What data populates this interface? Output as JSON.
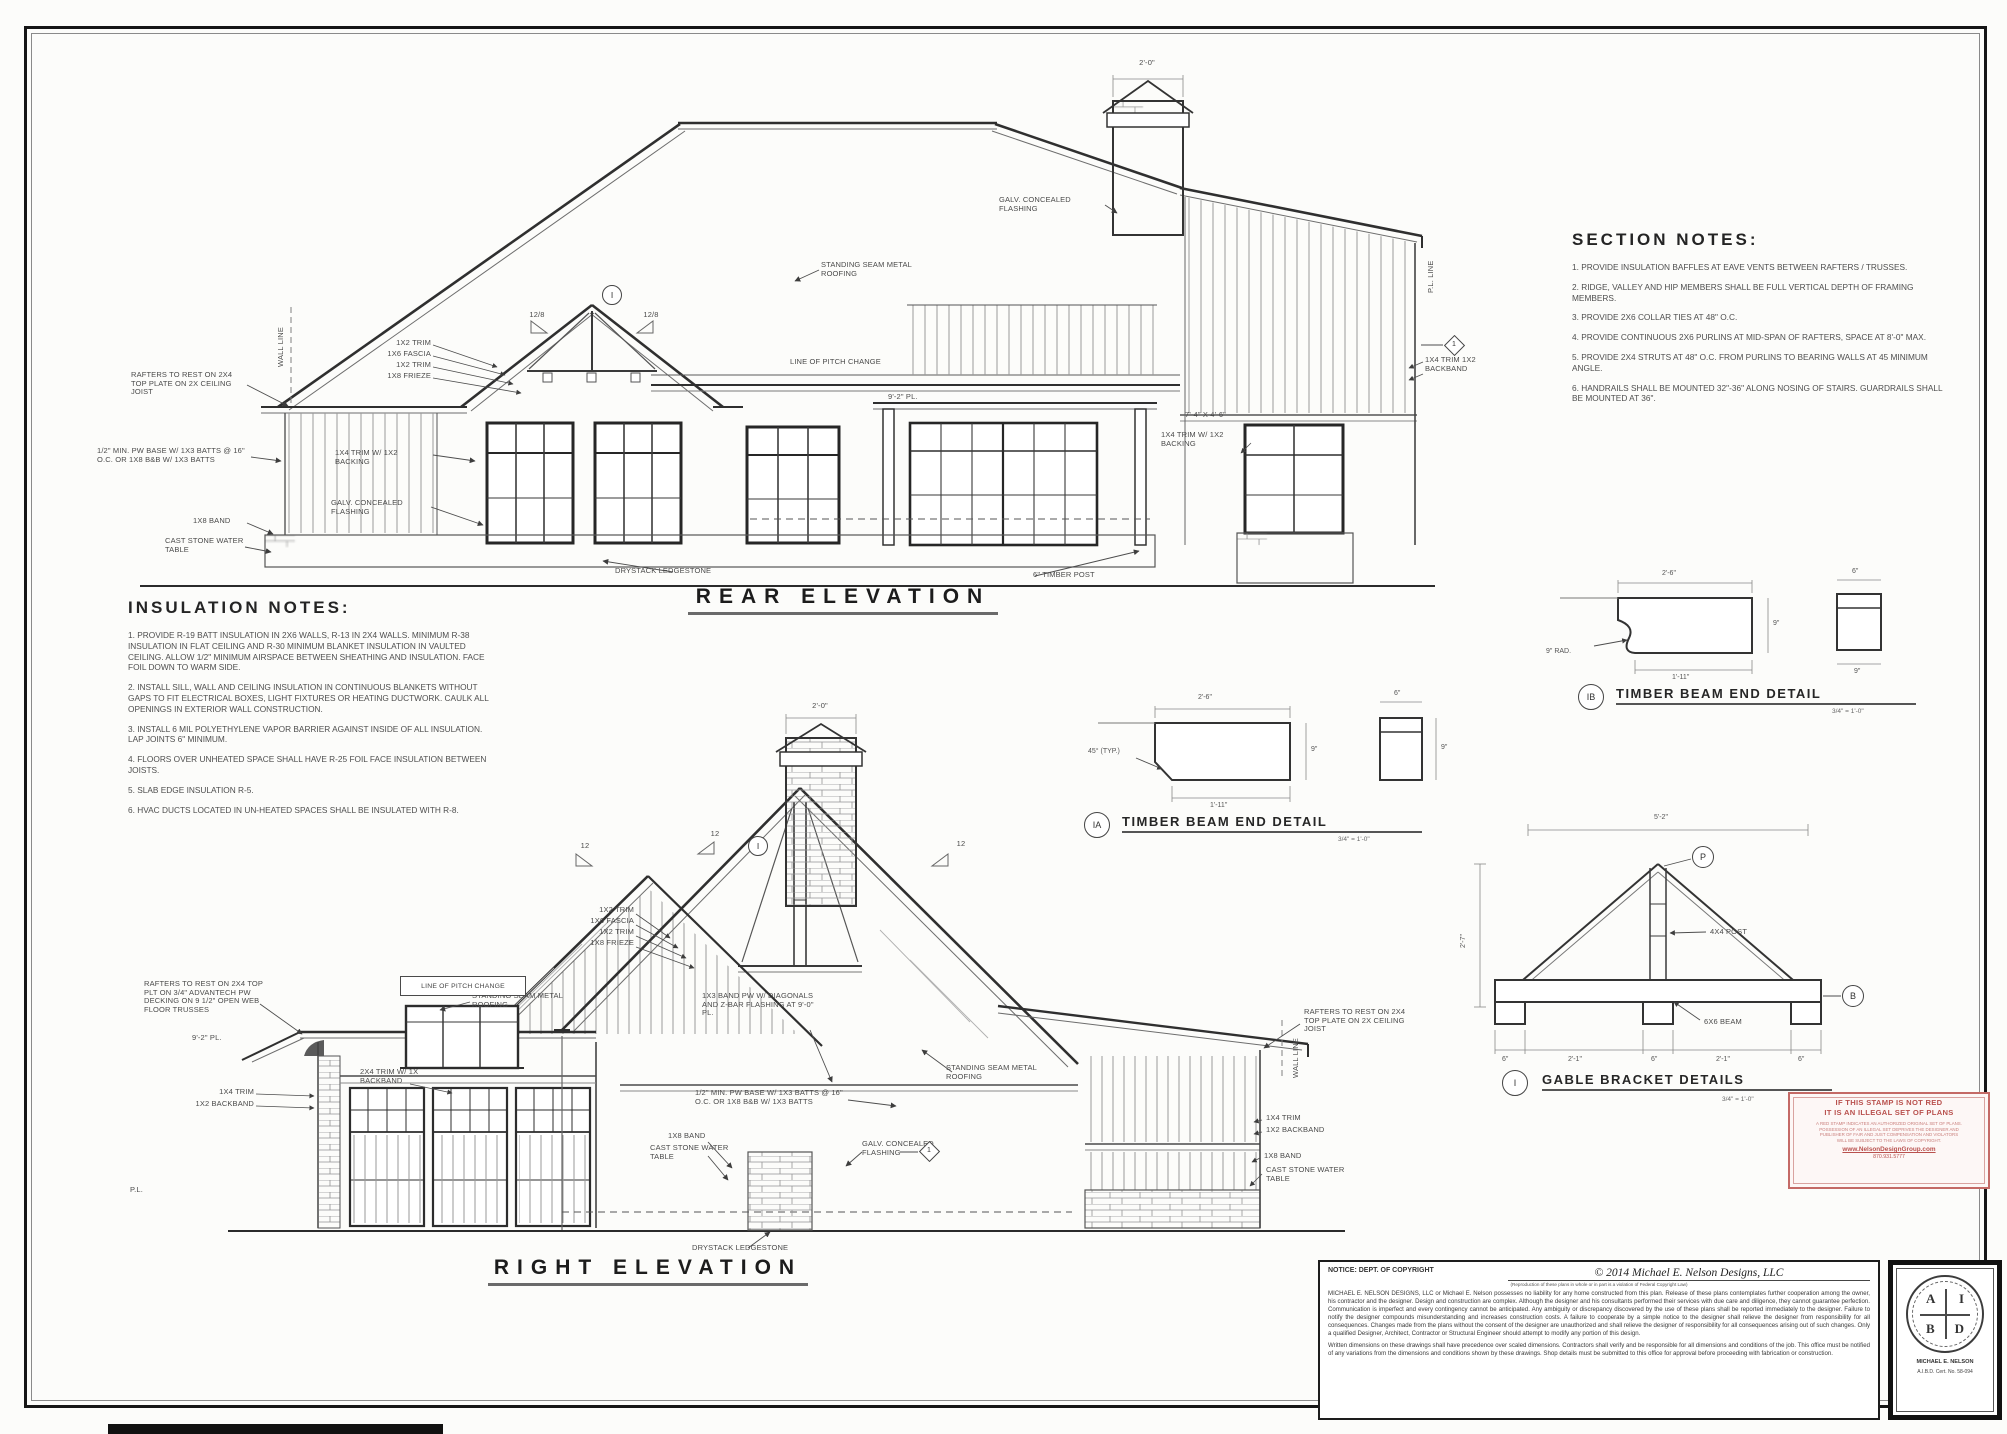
{
  "sheet": {
    "name": "ELEVATION SHEET",
    "paper_color": "#fcfcfa",
    "line_color": "#2f2f2f",
    "stamp_color": "#b9514e"
  },
  "notes": {
    "section": {
      "title": "SECTION NOTES:",
      "items": [
        "1. PROVIDE INSULATION BAFFLES AT EAVE VENTS BETWEEN RAFTERS / TRUSSES.",
        "2. RIDGE, VALLEY AND HIP MEMBERS SHALL BE FULL VERTICAL DEPTH OF FRAMING MEMBERS.",
        "3. PROVIDE 2X6 COLLAR TIES AT 48\" O.C.",
        "4. PROVIDE CONTINUOUS 2X6 PURLINS AT MID-SPAN OF RAFTERS, SPACE AT 8'-0\" MAX.",
        "5. PROVIDE 2X4 STRUTS AT 48\" O.C. FROM PURLINS TO BEARING WALLS AT 45 MINIMUM ANGLE.",
        "6. HANDRAILS SHALL BE MOUNTED 32\"-36\" ALONG NOSING OF STAIRS. GUARDRAILS SHALL BE MOUNTED AT 36\"."
      ]
    },
    "insulation": {
      "title": "INSULATION NOTES:",
      "items": [
        "1. PROVIDE R-19 BATT INSULATION IN 2X6 WALLS, R-13 IN 2X4 WALLS. MINIMUM R-38 INSULATION IN FLAT CEILING AND R-30 MINIMUM BLANKET INSULATION IN VAULTED CEILING. ALLOW 1/2\" MINIMUM AIRSPACE BETWEEN SHEATHING AND INSULATION. FACE FOIL DOWN TO WARM SIDE.",
        "2. INSTALL SILL, WALL AND CEILING INSULATION IN CONTINUOUS BLANKETS WITHOUT GAPS TO FIT ELECTRICAL BOXES, LIGHT FIXTURES OR HEATING DUCTWORK. CAULK ALL OPENINGS IN EXTERIOR WALL CONSTRUCTION.",
        "3. INSTALL 6 MIL POLYETHYLENE VAPOR BARRIER AGAINST INSIDE OF ALL INSULATION. LAP JOINTS 6\" MINIMUM.",
        "4. FLOORS OVER UNHEATED SPACE SHALL HAVE R-25 FOIL FACE INSULATION BETWEEN JOISTS.",
        "5. SLAB EDGE INSULATION R-5.",
        "6. HVAC DUCTS LOCATED IN UN-HEATED SPACES SHALL BE INSULATED WITH R-8."
      ]
    }
  },
  "rear": {
    "title": "REAR ELEVATION",
    "labels": {
      "rafters": "RAFTERS TO REST ON 2X4 TOP PLATE ON 2X CEILING JOIST",
      "pw_base": "1/2\" MIN. PW BASE W/ 1X3 BATTS @ 16\" O.C. OR 1X8 B&B W/ 1X3 BATTS",
      "band": "1X8 BAND",
      "water_table": "CAST STONE WATER TABLE",
      "flashing": "GALV. CONCEALED FLASHING",
      "trim12a": "1X2 TRIM",
      "fascia": "1X6 FASCIA",
      "trim12b": "1X2 TRIM",
      "frieze": "1X8 FRIEZE",
      "trim14_backing": "1X4 TRIM W/ 1X2 BACKING",
      "trim14_backband": "1X4 TRIM 1X2 BACKBAND",
      "seam": "STANDING SEAM METAL ROOFING",
      "pitch_change": "LINE OF PITCH CHANGE",
      "plate": "9'-2\" PL.",
      "window_dim": "7'-4\" X 4'-6\"",
      "ledgestone": "DRYSTACK LEDGESTONE",
      "timber_post": "6\" TIMBER POST",
      "wall_line": "WALL LINE",
      "pl_line": "P.L. LINE",
      "chimney_dim": "2'-0\"",
      "pitch": "12/8",
      "apex_marker": "I",
      "diamond": "1"
    }
  },
  "right": {
    "title": "RIGHT ELEVATION",
    "labels": {
      "rafters_floor": "RAFTERS TO REST ON 2X4 TOP PLT ON 3/4\" ADVANTECH PW DECKING ON 9 1/2\" OPEN WEB FLOOR TRUSSES",
      "rafters_ceiling": "RAFTERS TO REST ON 2X4 TOP PLATE ON 2X CEILING JOIST",
      "plate": "9'-2\" PL.",
      "trim14": "1X4 TRIM",
      "backband": "1X2 BACKBAND",
      "trim24_backband": "2X4 TRIM W/ 1X BACKBAND",
      "seam": "STANDING SEAM METAL ROOFING",
      "trim12a": "1X2 TRIM",
      "fascia": "1X6 FASCIA",
      "trim12b": "1X2 TRIM",
      "frieze": "1X8 FRIEZE",
      "band_flash": "1X3 BAND PW W/ DIAGONALS AND Z-BAR FLASHING AT 9'-0\" PL.",
      "pw_base": "1/2\" MIN. PW BASE W/ 1X3 BATTS @ 16\" O.C. OR 1X8 B&B W/ 1X3 BATTS",
      "band": "1X8 BAND",
      "water_table": "CAST STONE WATER TABLE",
      "flashing": "GALV. CONCEALED FLASHING",
      "pitch_box": "LINE OF PITCH CHANGE",
      "ledgestone": "DRYSTACK LEDGESTONE",
      "wall_line": "WALL LINE",
      "pl": "P.L.",
      "chimney_dim": "2'-0\"",
      "pitch": "12",
      "apex_marker": "I",
      "diamond": "1"
    }
  },
  "details": {
    "timber_a": {
      "marker": "IA",
      "title": "TIMBER BEAM END DETAIL",
      "scale": "3/4\" = 1'-0\"",
      "dim_top": "2'-6\"",
      "dim_bottom": "1'-11\"",
      "dim_side": "9\"",
      "angle": "45° (TYP.)",
      "end_w": "6\"",
      "end_h": "9\""
    },
    "timber_b": {
      "marker": "IB",
      "title": "TIMBER BEAM END DETAIL",
      "scale": "3/4\" = 1'-0\"",
      "dim_top": "2'-6\"",
      "dim_bottom": "1'-11\"",
      "dim_side": "9\"",
      "radius": "9\" RAD.",
      "end_w": "6\"",
      "end_h": "9\""
    },
    "gable": {
      "marker": "I",
      "title": "GABLE BRACKET DETAILS",
      "scale": "3/4\" = 1'-0\"",
      "post": "4X4 POST",
      "beam": "6X6 BEAM",
      "dim_top": "5'-2\"",
      "dim_left": "2'-7\"",
      "dim_b1": "6\"",
      "dim_b2": "2'-1\"",
      "dim_b3": "6\"",
      "dim_b4": "2'-1\"",
      "dim_b5": "6\"",
      "marker_p": "P",
      "marker_b": "B"
    }
  },
  "stamp": {
    "line1": "IF THIS STAMP IS NOT RED",
    "line2": "IT IS AN ILLEGAL SET OF PLANS",
    "small1": "A RED STAMP INDICATES AN AUTHORIZED ORIGINAL SET OF PLANS.",
    "small2": "POSSESSION OF AN ILLEGAL SET DEPRIVES THE DESIGNER AND",
    "small3": "PUBLISHER OF FAIR AND JUST COMPENSATION AND VIOLATORS",
    "small4": "WILL BE SUBJECT TO THE LAWS OF COPYRIGHT.",
    "url": "www.NelsonDesignGroup.com",
    "phone": "870.931.5777"
  },
  "copyright": {
    "notice": "NOTICE: DEPT. OF COPYRIGHT",
    "title": "© 2014 Michael E. Nelson Designs, LLC",
    "subtitle": "(Reproduction of these plans in whole or in part is a violation of Federal Copyright Law)",
    "body1": "MICHAEL E. NELSON DESIGNS, LLC or Michael E. Nelson possesses no liability for any home constructed from this plan. Release of these plans contemplates further cooperation among the owner, his contractor and the designer. Design and construction are complex. Although the designer and his consultants performed their services with due care and diligence, they cannot guarantee perfection. Communication is imperfect and every contingency cannot be anticipated. Any ambiguity or discrepancy discovered by the use of these plans shall be reported immediately to the designer. Failure to notify the designer compounds misunderstanding and increases construction costs. A failure to cooperate by a simple notice to the designer shall relieve the designer from responsibility for all consequences. Changes made from the plans without the consent of the designer are unauthorized and shall relieve the designer of responsibility for all consequences arising out of such changes. Only a qualified Designer, Architect, Contractor or Structural Engineer should attempt to modify any portion of this design.",
    "body2": "Written dimensions on these drawings shall have precedence over scaled dimensions. Contractors shall verify and be responsible for all dimensions and conditions of the job. This office must be notified of any variations from the dimensions and conditions shown by these drawings. Shop details must be submitted to this office for approval before proceeding with fabrication or construction."
  },
  "seal": {
    "l1": "A",
    "l2": "I",
    "l3": "B",
    "l4": "D",
    "name": "MICHAEL E. NELSON",
    "cert": "A.I.B.D. Cert. No. 58-094"
  }
}
